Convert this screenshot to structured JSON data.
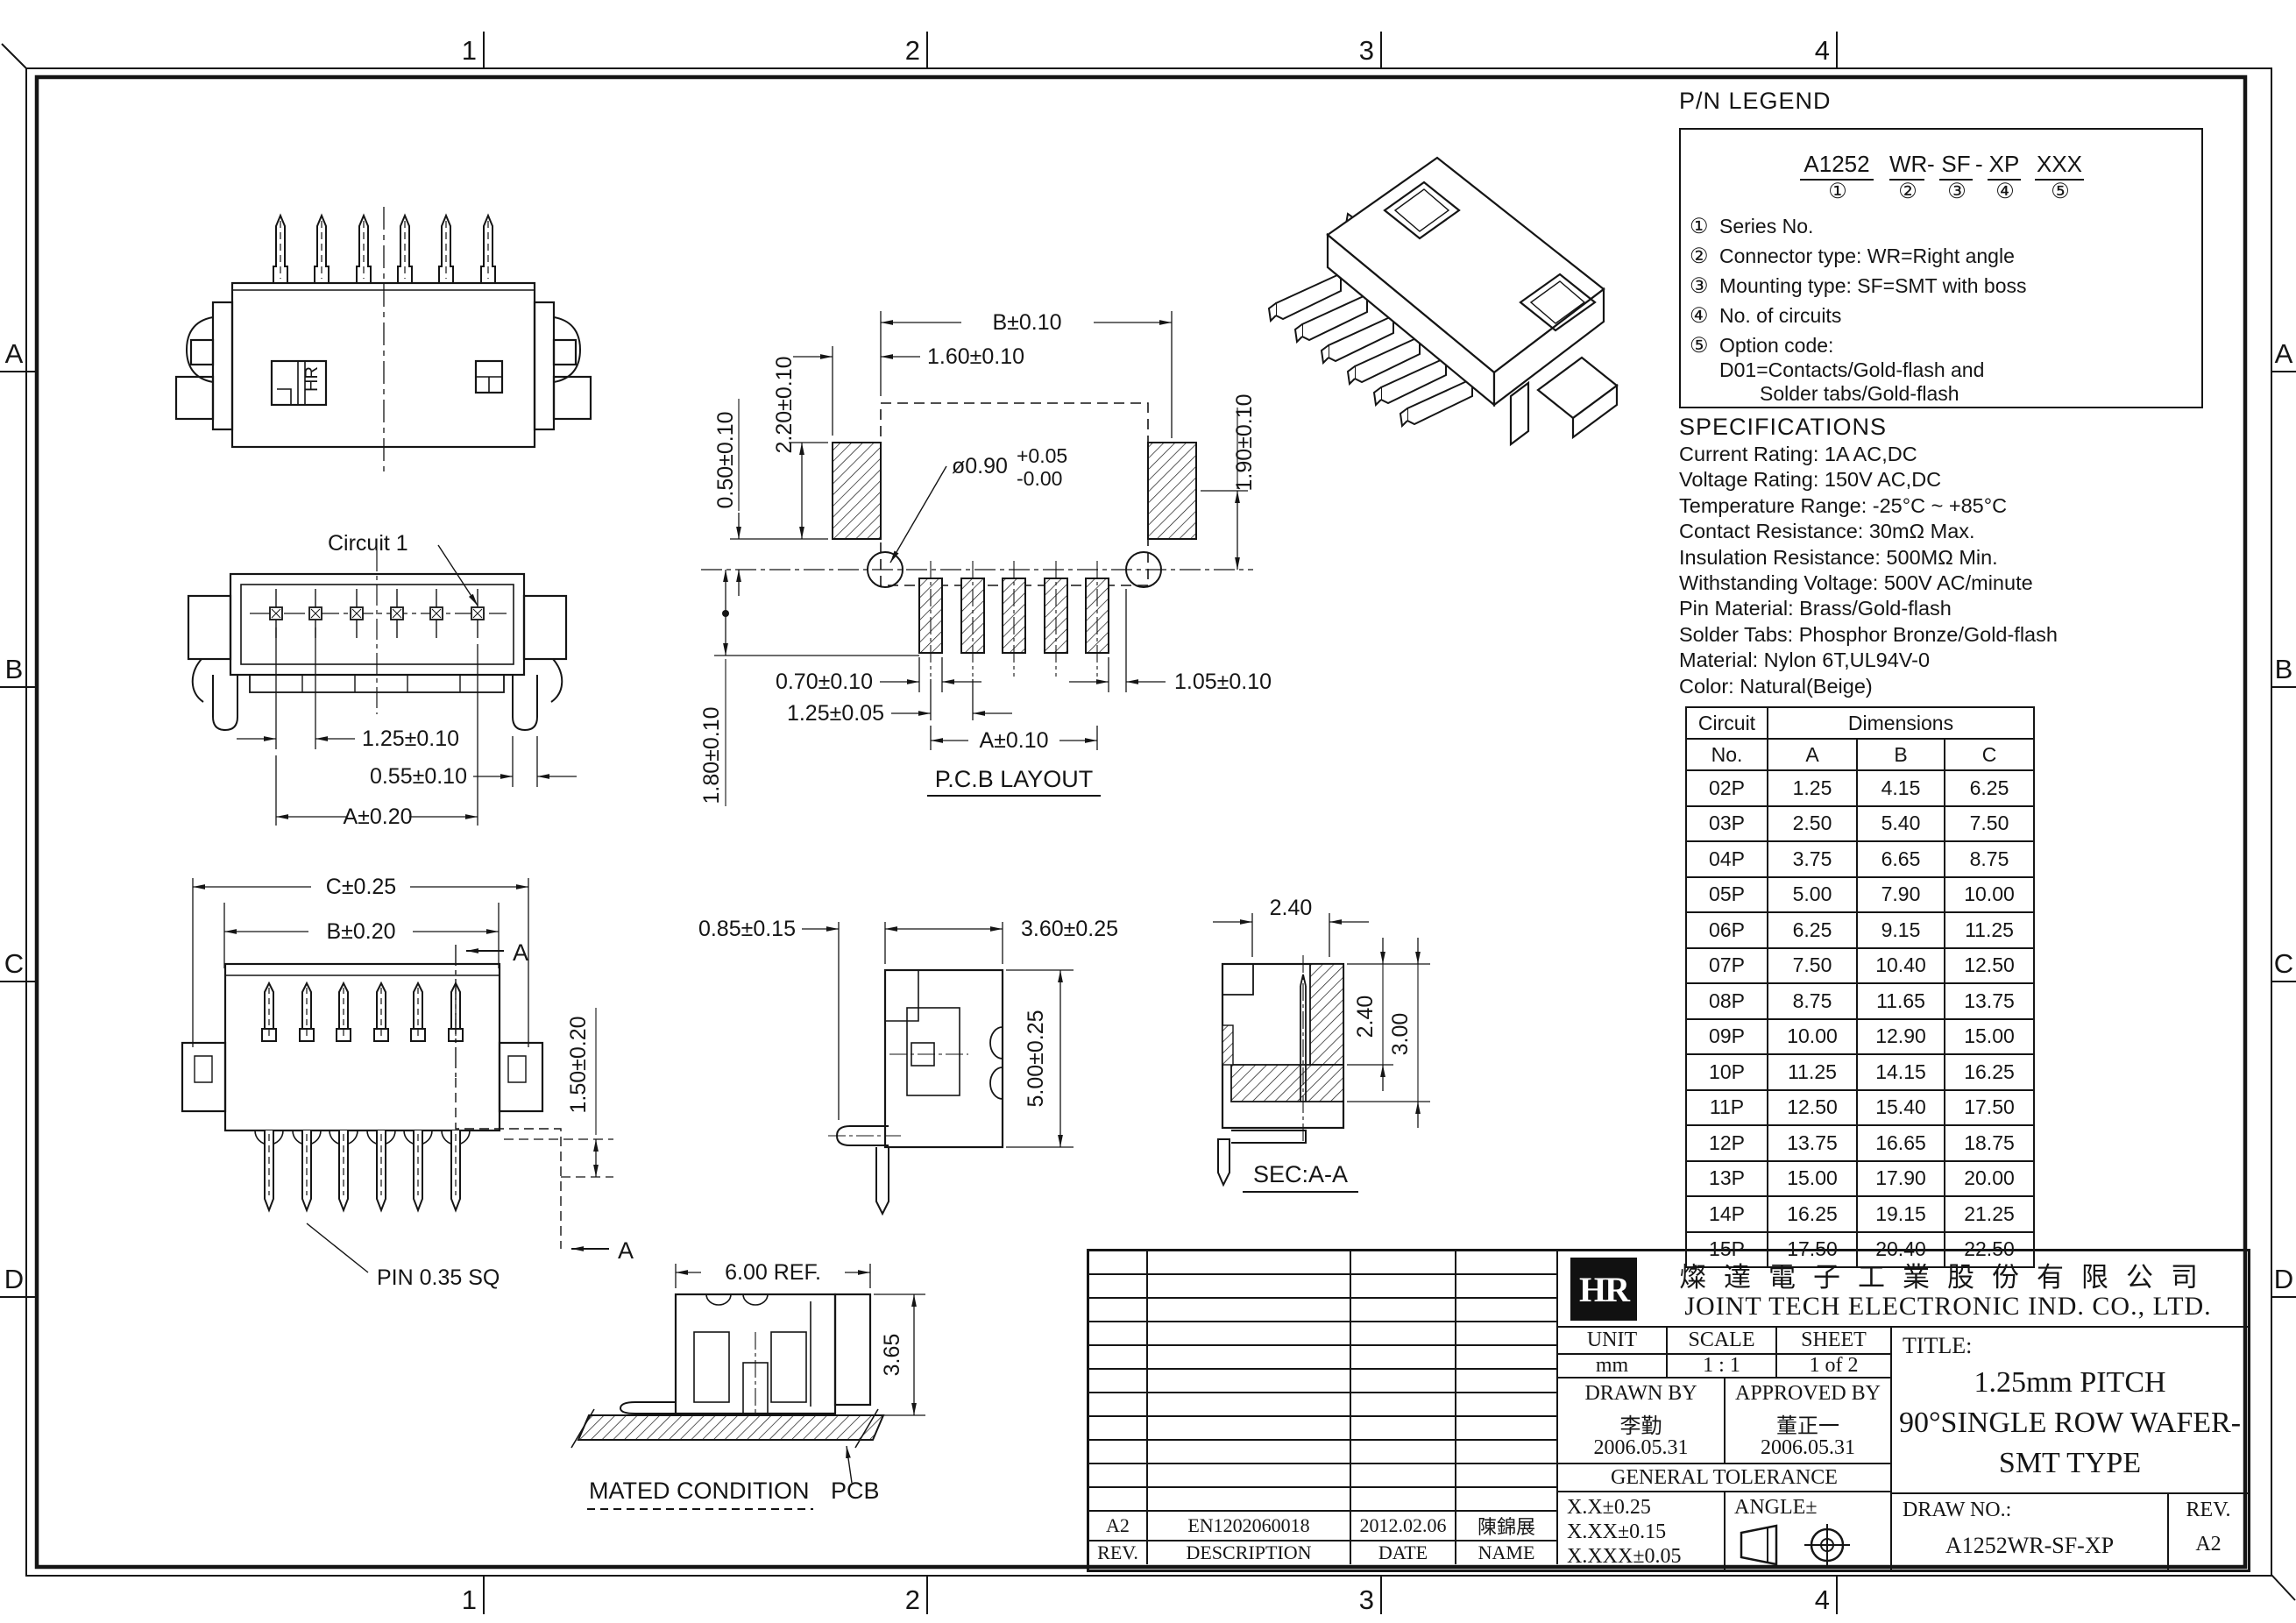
{
  "sheet": {
    "zones_h": [
      "1",
      "2",
      "3",
      "4"
    ],
    "zones_v": [
      "A",
      "B",
      "C",
      "D"
    ]
  },
  "pn_legend": {
    "title": "P/N LEGEND",
    "code": {
      "s1": "A1252",
      "s2": "WR",
      "s3": "SF",
      "s4": "XP",
      "s5": "XXX",
      "dash": "-"
    },
    "circles": [
      "①",
      "②",
      "③",
      "④",
      "⑤"
    ],
    "items": [
      {
        "num": "①",
        "text": "Series No."
      },
      {
        "num": "②",
        "text": "Connector type: WR=Right angle"
      },
      {
        "num": "③",
        "text": "Mounting type: SF=SMT with boss"
      },
      {
        "num": "④",
        "text": "No. of circuits"
      },
      {
        "num": "⑤",
        "text": "Option code:"
      },
      {
        "num": "",
        "text": "D01=Contacts/Gold-flash and"
      },
      {
        "num": "",
        "text": "Solder tabs/Gold-flash"
      }
    ]
  },
  "specs": {
    "title": "SPECIFICATIONS",
    "lines": [
      "Current Rating: 1A AC,DC",
      "Voltage Rating: 150V AC,DC",
      "Temperature Range: -25°C ~ +85°C",
      "Contact Resistance: 30mΩ Max.",
      "Insulation Resistance: 500MΩ Min.",
      "Withstanding Voltage: 500V AC/minute",
      "Pin Material: Brass/Gold-flash",
      "Solder Tabs: Phosphor Bronze/Gold-flash",
      "Material: Nylon 6T,UL94V-0",
      "Color: Natural(Beige)"
    ]
  },
  "circuit_table": {
    "h_circuit": "Circuit",
    "h_dimensions": "Dimensions",
    "sub": [
      "No.",
      "A",
      "B",
      "C"
    ],
    "rows": [
      [
        "02P",
        "1.25",
        "4.15",
        "6.25"
      ],
      [
        "03P",
        "2.50",
        "5.40",
        "7.50"
      ],
      [
        "04P",
        "3.75",
        "6.65",
        "8.75"
      ],
      [
        "05P",
        "5.00",
        "7.90",
        "10.00"
      ],
      [
        "06P",
        "6.25",
        "9.15",
        "11.25"
      ],
      [
        "07P",
        "7.50",
        "10.40",
        "12.50"
      ],
      [
        "08P",
        "8.75",
        "11.65",
        "13.75"
      ],
      [
        "09P",
        "10.00",
        "12.90",
        "15.00"
      ],
      [
        "10P",
        "11.25",
        "14.15",
        "16.25"
      ],
      [
        "11P",
        "12.50",
        "15.40",
        "17.50"
      ],
      [
        "12P",
        "13.75",
        "16.65",
        "18.75"
      ],
      [
        "13P",
        "15.00",
        "17.90",
        "20.00"
      ],
      [
        "14P",
        "16.25",
        "19.15",
        "21.25"
      ],
      [
        "15P",
        "17.50",
        "20.40",
        "22.50"
      ]
    ]
  },
  "views": {
    "top": {
      "marking": "HR"
    },
    "front": {
      "label": "Circuit 1",
      "dim_pitch": "1.25±0.10",
      "dim_tab": "0.55±0.10",
      "dim_a": "A±0.20"
    },
    "bottom": {
      "dim_c": "C±0.25",
      "dim_b": "B±0.20",
      "sec_mark": "A",
      "dim_h": "1.50±0.20",
      "pin_note": "PIN 0.35 SQ"
    },
    "pcb": {
      "label": "P.C.B LAYOUT",
      "dim_b": "B±0.10",
      "dim_160": "1.60±0.10",
      "dim_220": "2.20±0.10",
      "dim_050": "0.50±0.10",
      "hole": "ø0.90",
      "hole_p": "+0.05",
      "hole_m": "-0.00",
      "dim_190": "1.90±0.10",
      "dim_070": "0.70±0.10",
      "dim_125": "1.25±0.05",
      "dim_105": "1.05±0.10",
      "dim_a": "A±0.10",
      "dim_180": "1.80±0.10"
    },
    "side": {
      "dim_085": "0.85±0.15",
      "dim_360": "3.60±0.25",
      "dim_500": "5.00±0.25"
    },
    "sec": {
      "label": "SEC:A-A",
      "d240t": "2.40",
      "d240r": "2.40",
      "d300": "3.00"
    },
    "mated": {
      "label": "MATED CONDITION",
      "dim_600": "6.00  REF.",
      "dim_365": "3.65",
      "pcb": "PCB"
    }
  },
  "title_block": {
    "logo_text": "HR",
    "company_cn": "燦達電子工業股份有限公司",
    "company_en": "JOINT TECH ELECTRONIC IND. CO., LTD.",
    "unit_label": "UNIT",
    "unit_value": "mm",
    "scale_label": "SCALE",
    "scale_value": "1 : 1",
    "sheet_label": "SHEET",
    "sheet_value": "1 of 2",
    "drawn_label": "DRAWN BY",
    "drawn_name": "李勤",
    "drawn_date": "2006.05.31",
    "approved_label": "APPROVED BY",
    "approved_name": "董正一",
    "approved_date": "2006.05.31",
    "tol_title": "GENERAL TOLERANCE",
    "tols": [
      "X.X±0.25",
      "X.XX±0.15",
      "X.XXX±0.05"
    ],
    "angle_label": "ANGLE±",
    "title_label": "TITLE:",
    "title_lines": [
      "1.25mm PITCH",
      "90°SINGLE ROW WAFER-",
      "SMT TYPE"
    ],
    "drawno_label": "DRAW NO.:",
    "drawno_value": "A1252WR-SF-XP",
    "rev_label": "REV.",
    "rev_value": "A2"
  },
  "revision_table": {
    "empty_rows": 11,
    "entry": {
      "rev": "A2",
      "description": "EN1202060018",
      "date": "2012.02.06",
      "name": "陳錦展"
    },
    "headers": [
      "REV.",
      "DESCRIPTION",
      "DATE",
      "NAME"
    ]
  }
}
